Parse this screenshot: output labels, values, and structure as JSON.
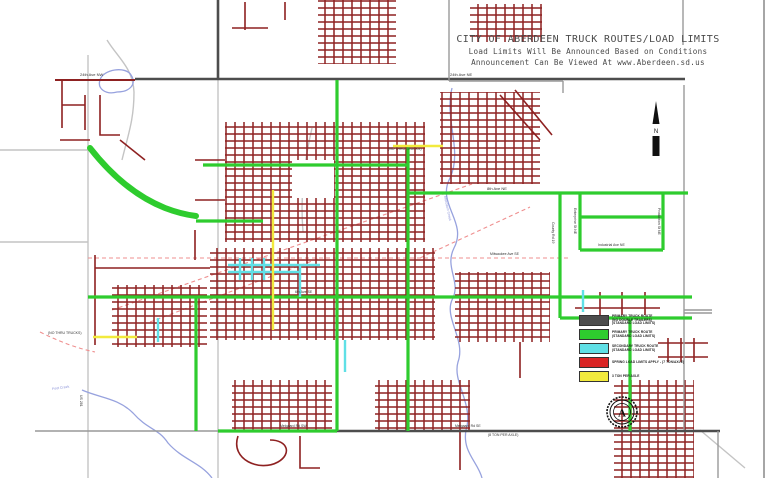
{
  "colors": {
    "dark_red": "#8e2121",
    "green": "#2ecc2e",
    "cyan": "#5fe0e6",
    "yellow": "#f2ea3d",
    "red": "#d92525",
    "primary_gray": "#4d4d4d",
    "rail_pink": "#ef8f8f",
    "water_blue": "#97a2de",
    "base_gray": "#c4c4c4",
    "text_gray": "#4a4a4a"
  },
  "title": {
    "line1": "CITY OF ABERDEEN TRUCK ROUTES/LOAD LIMITS",
    "line2": "Load Limits Will Be Announced Based on Conditions",
    "line3": "Announcement Can Be Viewed At www.Aberdeen.sd.us"
  },
  "north": {
    "label": "N"
  },
  "seal": {
    "letter": "A"
  },
  "legend": {
    "items": [
      {
        "color": "#4d4d4d",
        "lines": [
          "PRIMARY TRUCK ROUTE",
          "(NO DOUBLE TRAILERS)",
          "(STANDARD LOAD LIMITS)"
        ]
      },
      {
        "color": "#2ecc2e",
        "lines": [
          "PRIMARY TRUCK ROUTE",
          "(STANDARD LOAD LIMITS)"
        ]
      },
      {
        "color": "#5fe0e6",
        "lines": [
          "SECONDARY TRUCK ROUTE",
          "(STANDARD LOAD LIMITS)"
        ]
      },
      {
        "color": "#d92525",
        "lines": [
          "SPRING LOAD LIMITS APPLY - (7 TON/AXLE)"
        ]
      },
      {
        "color": "#f2ea3d",
        "lines": [
          "3 TON PER AXLE"
        ]
      }
    ]
  },
  "map": {
    "labels": [
      {
        "text": "24th Ave NW",
        "x": 80,
        "y": 73,
        "size": 4
      },
      {
        "text": "24th Ave NE",
        "x": 450,
        "y": 73,
        "size": 4
      },
      {
        "text": "(NO THRU TRUCKS)",
        "x": 388,
        "y": 148,
        "size": 3.5
      },
      {
        "text": "(NO THRU TRUCKS)",
        "x": 48,
        "y": 332,
        "size": 3.5
      },
      {
        "text": "8th Ave NE",
        "x": 487,
        "y": 187,
        "size": 4
      },
      {
        "text": "Industrial Ave NE",
        "x": 598,
        "y": 244,
        "size": 3.5
      },
      {
        "text": "Enterprise St NE",
        "x": 576,
        "y": 208,
        "rot": 90,
        "size": 3.5
      },
      {
        "text": "Production St NE",
        "x": 660,
        "y": 208,
        "rot": 90,
        "size": 3.5
      },
      {
        "text": "Milwaukee Ave SE",
        "x": 490,
        "y": 253,
        "size": 3.5
      },
      {
        "text": "6th Ave SE",
        "x": 295,
        "y": 291,
        "size": 3.5
      },
      {
        "text": "Moccasin Creek",
        "x": 446,
        "y": 196,
        "rot": 78,
        "size": 3.5,
        "color": "#8890d8"
      },
      {
        "text": "Melgaard Rd SW",
        "x": 280,
        "y": 425,
        "size": 3.5
      },
      {
        "text": "Melgaard Rd SE",
        "x": 455,
        "y": 425,
        "size": 3.5
      },
      {
        "text": "(8 TON PER AXLE)",
        "x": 488,
        "y": 434,
        "size": 3.5
      },
      {
        "text": "Foot Creek",
        "x": 52,
        "y": 388,
        "rot": -8,
        "size": 3.5,
        "color": "#8890d8"
      },
      {
        "text": "US 281",
        "x": 82,
        "y": 395,
        "rot": 90,
        "size": 3.5
      },
      {
        "text": "County Rd 19",
        "x": 554,
        "y": 222,
        "rot": 90,
        "size": 3.5
      }
    ]
  }
}
